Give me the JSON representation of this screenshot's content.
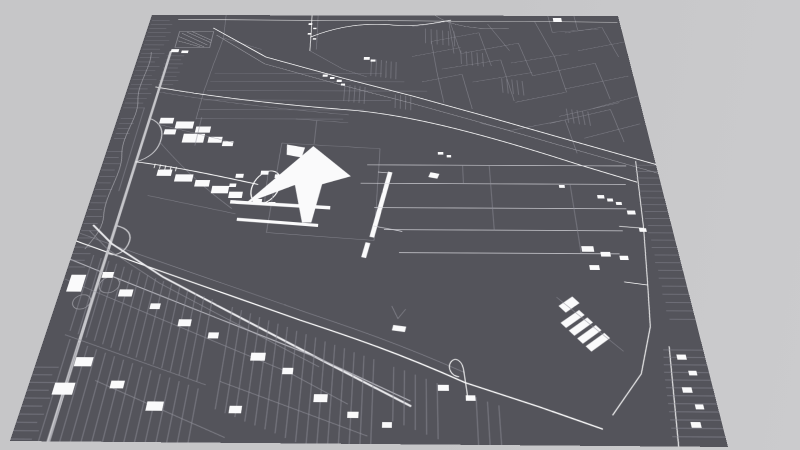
{
  "scene": {
    "kind": "monochrome-3d-map-render",
    "view": "oblique perspective of a square map plate on a plain ground",
    "landmarks": [
      "airport-terminal-building",
      "terminal-piers",
      "terminal-access-loop",
      "runway-strip",
      "taxiway-lines",
      "cargo-buildings",
      "west-motorway",
      "motorway-interchange-loops",
      "southwest-avenue",
      "north-field-parcels",
      "field-hatch-rows",
      "west-greenhouse-rows",
      "airport-north-perimeter-road",
      "airport-south-perimeter-road",
      "east-perimeter-road",
      "south-street-grid",
      "south-buildings",
      "southeast-depot-buildings",
      "east-street-band",
      "southeast-corner-grid",
      "balloon-loop-road",
      "canals",
      "northwest-industrial-buildings",
      "scattered-buildings"
    ]
  },
  "colors": {
    "background": "#c6c6c8",
    "background_hi": "#cbcbcd",
    "plate": "#54545b",
    "street_minor": "#90909a",
    "street_medium": "#b9b9c0",
    "street_major": "#ffffff",
    "motorway": "#c6c6ca",
    "avenue": "#e9e9ec",
    "taxiway": "#d8d8de",
    "building": "#fafafb"
  }
}
